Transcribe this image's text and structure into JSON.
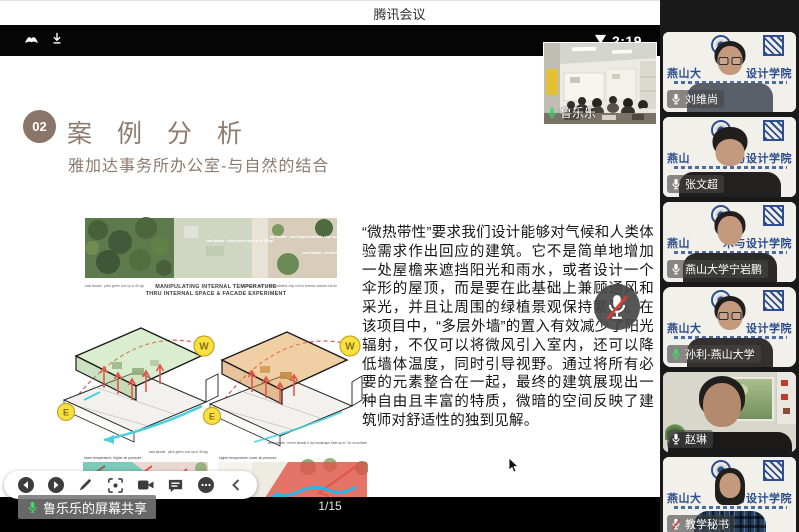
{
  "window": {
    "title": "腾讯会议"
  },
  "phone_status": {
    "time": "2:19",
    "icons": [
      "app-notification-icon",
      "download-icon",
      "saver-triangle-icon"
    ]
  },
  "slide": {
    "number": "02",
    "title": "案 例 分 析",
    "subtitle": "雅加达事务所办公室-与自然的结合",
    "body": "“微热带性”要求我们设计能够对气候和人类体验需求作出回应的建筑。它不是简单地增加一处屋檐来遮挡阳光和雨水，或者设计一个伞形的屋顶，而是要在此基础上兼顾通风和采光，并且让周围的绿植景观保持繁茂。在该项目中，“多层外墙”的置入有效减少了阳光辐射，不仅可以将微风引入室内，还可以降低墙体温度，同时引导视野。通过将所有必要的元素整合在一起，最终的建筑展现出一种自由且丰富的特质，微暗的空间反映了建筑师对舒适性的独到见解。",
    "page": "1/15",
    "diagram": {
      "caption1": "MANIPULATING INTERNAL TEMPERATURE",
      "caption2": "THRU INTERNAL SPACE & FACADE EXPERIMENT",
      "east_facade": "east facade : pitch green roof up to 45 dgr",
      "top_facade": "top facade : low firing breathable clay roof to release stacked hot air",
      "west_facade": "west facade : mirror facade & dry landscape heat up to +3c on surface",
      "label_w": "W",
      "label_e": "E",
      "note_left": "lower temperature, higher air pressure",
      "note_right": "higher temperature, lower air pressure"
    }
  },
  "self_view": {
    "name": "鲁乐乐"
  },
  "share_banner": {
    "text": "鲁乐乐的屏幕共享"
  },
  "toolbar": {
    "icons": [
      "previous-slide",
      "next-slide",
      "annotate-pen",
      "screenshot-frame",
      "camera",
      "chat",
      "more",
      "collapse-panel"
    ]
  },
  "participants": [
    {
      "name": "刘维尚",
      "mic": "on",
      "variant": 1,
      "active": false,
      "bg": {
        "left": "燕山大",
        "right": "设计学院"
      }
    },
    {
      "name": "张文超",
      "mic": "on",
      "variant": 2,
      "active": false,
      "bg": {
        "left": "燕山",
        "right": "与设计学院"
      }
    },
    {
      "name": "燕山大学宁岩鹏",
      "mic": "on",
      "variant": 3,
      "active": false,
      "bg": {
        "left": "燕山",
        "right": "术与设计学院"
      }
    },
    {
      "name": "孙利-燕山大学",
      "mic": "speaking",
      "variant": 4,
      "active": true,
      "bg": {
        "left": "燕山大",
        "right": "设计学院"
      }
    },
    {
      "name": "赵琳",
      "mic": "on",
      "variant": 5,
      "active": false,
      "bg": null
    },
    {
      "name": "教学秘书",
      "mic": "muted",
      "variant": 6,
      "active": false,
      "bg": {
        "left": "燕山大",
        "right": "术与设计学院"
      }
    }
  ],
  "colors": {
    "accent_green": "#29a85f",
    "mic_green": "#3ddc68",
    "slide_accent": "#8d7b6e",
    "diagram_red": "#e2574b",
    "diagram_cyan": "#25b5ea",
    "diagram_yellow": "#f7e23d",
    "logo_blue": "#2e4e8f"
  }
}
